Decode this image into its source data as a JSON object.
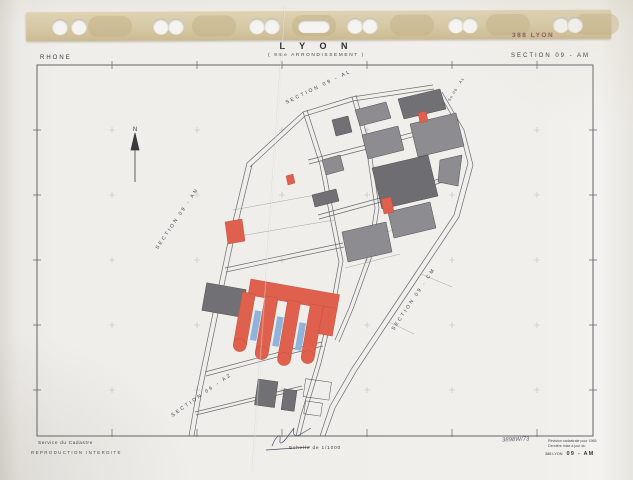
{
  "binder": {
    "stamp": "388 LYON"
  },
  "header": {
    "department": "RHONE",
    "title": "L Y O N",
    "subtitle": "( 9me  ARRONDISSEMENT )",
    "section": "SECTION  09 - AM"
  },
  "map": {
    "north_label": "N",
    "section_labels": [
      {
        "id": "al",
        "text": "SECTION  09 - AL"
      },
      {
        "id": "al-small",
        "text": "Sn 09 - AL"
      },
      {
        "id": "an",
        "text": "SECTION  09 - AN"
      },
      {
        "id": "cm",
        "text": "SECTION  09 - CM"
      },
      {
        "id": "az",
        "text": "SECTION  09 - AZ"
      }
    ]
  },
  "footer": {
    "service": "Service du Cadastre",
    "notice": "REPRODUCTION INTERDITE",
    "scale": "Echelle de 1/1000",
    "handwritten": "3898W/73",
    "revision_line1": "Révision cadastrale pour 1965",
    "revision_line2": "Dernière mise à jour du",
    "reference": "388 LYON",
    "section_ref": "09 - AM"
  },
  "colors": {
    "paper": "#efeeea",
    "binder_strip": "#d6c8a4",
    "stamp_red": "#7e4c54",
    "line": "#55555a",
    "building_gray": "#8d8d91",
    "building_dark": "#717175",
    "building_red": "#e0604e",
    "accent_blue": "#8fb3da"
  }
}
